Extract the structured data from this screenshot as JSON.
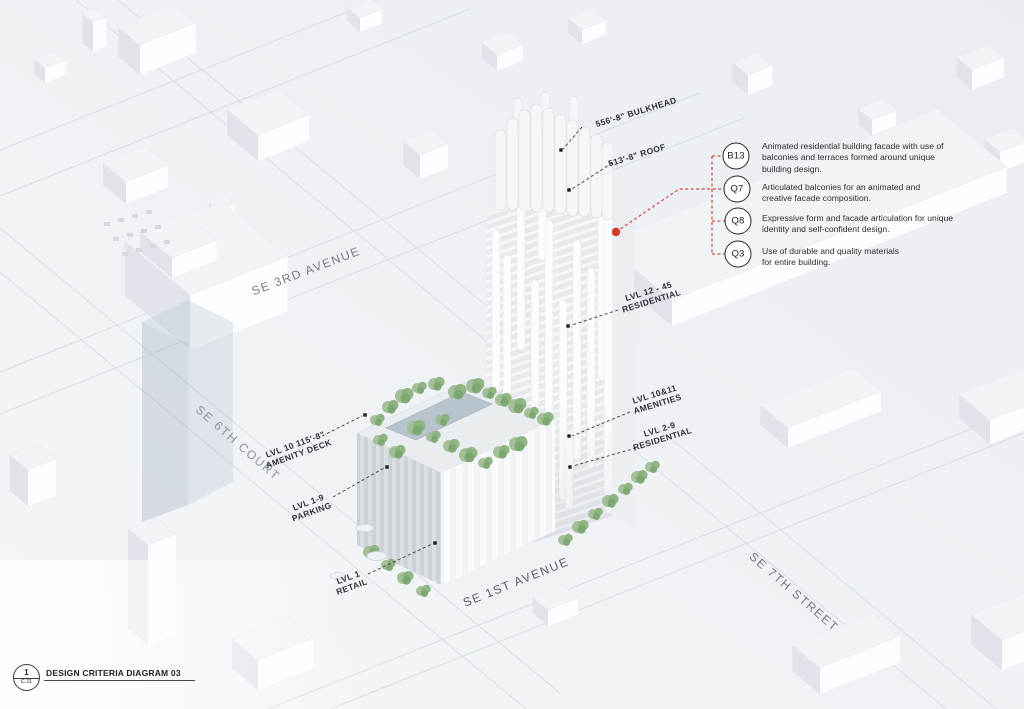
{
  "streets": [
    {
      "name": "SE 3RD AVENUE"
    },
    {
      "name": "SE 6TH COURT"
    },
    {
      "name": "SE 1ST AVENUE"
    },
    {
      "name": "SE 7TH STREET"
    }
  ],
  "levels": [
    {
      "line1": "556'-8\" BULKHEAD",
      "line2": ""
    },
    {
      "line1": "513'-8\" ROOF",
      "line2": ""
    },
    {
      "line1": "LVL 12 - 45",
      "line2": "RESIDENTIAL"
    },
    {
      "line1": "LVL 10&11",
      "line2": "AMENITIES"
    },
    {
      "line1": "LVL 2-9",
      "line2": "RESIDENTIAL"
    },
    {
      "line1": "LVL 10 115'-8\"",
      "line2": "AMENITY DECK"
    },
    {
      "line1": "LVL 1-9",
      "line2": "PARKING"
    },
    {
      "line1": "LVL 1",
      "line2": "RETAIL"
    }
  ],
  "callouts": [
    {
      "code": "B13",
      "text": "Animated residential building facade with use of balconies and terraces formed around unique building design."
    },
    {
      "code": "Q7",
      "text": "Articulated balconies for an animated and creative facade composition."
    },
    {
      "code": "Q8",
      "text": "Expressive form and facade articulation for unique identity and self-confident design."
    },
    {
      "code": "Q3",
      "text": "Use of durable and quality materials for entire building."
    }
  ],
  "title_block": {
    "detail_number": "1",
    "sheet_ref": "C.11",
    "title": "DESIGN CRITERIA DIAGRAM 03"
  },
  "colors": {
    "annotation_red": "#d8473c",
    "tree_green": "#8fb483",
    "pool_blue": "#b7c4cd"
  }
}
